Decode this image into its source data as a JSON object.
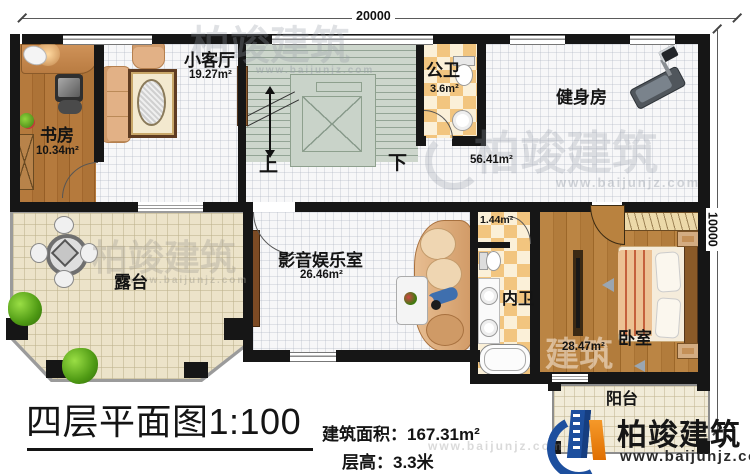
{
  "dim": {
    "top": "20000",
    "right": "10000"
  },
  "title": "四层平面图1:100",
  "specs": {
    "area": "建筑面积：167.31m²",
    "floor_height": "层高：3.3米"
  },
  "rooms": {
    "study": {
      "name": "书房",
      "area": "10.34m²"
    },
    "living": {
      "name": "小客厅",
      "area": "19.27m²"
    },
    "pub_bath": {
      "name": "公卫",
      "area": "3.6m²"
    },
    "gym": {
      "name": "健身房",
      "area": "56.41m²"
    },
    "media": {
      "name": "影音娱乐室",
      "area": "26.46m²"
    },
    "closet": {
      "area": "1.44m²"
    },
    "inner_bath": {
      "name": "内卫"
    },
    "bedroom": {
      "name": "卧室",
      "area": "28.47m²"
    },
    "terrace": {
      "name": "露台"
    },
    "balcony": {
      "name": "阳台"
    }
  },
  "stairs": {
    "up": "上",
    "down": "下"
  },
  "brand": {
    "name": "柏竣建筑",
    "website": "www.baijunjz.com"
  },
  "watermarks": {
    "name": "柏竣建筑",
    "website": "www.baijunjz.com",
    "short": "建筑"
  },
  "colors": {
    "wall": "#161616",
    "brand_blue": "#1d4f9e",
    "brand_orange": "#f08300",
    "wood": "#a9713a",
    "tile_check": "#f2c57f",
    "stair": "#cdd6cc",
    "terrace": "#ece3c9"
  }
}
